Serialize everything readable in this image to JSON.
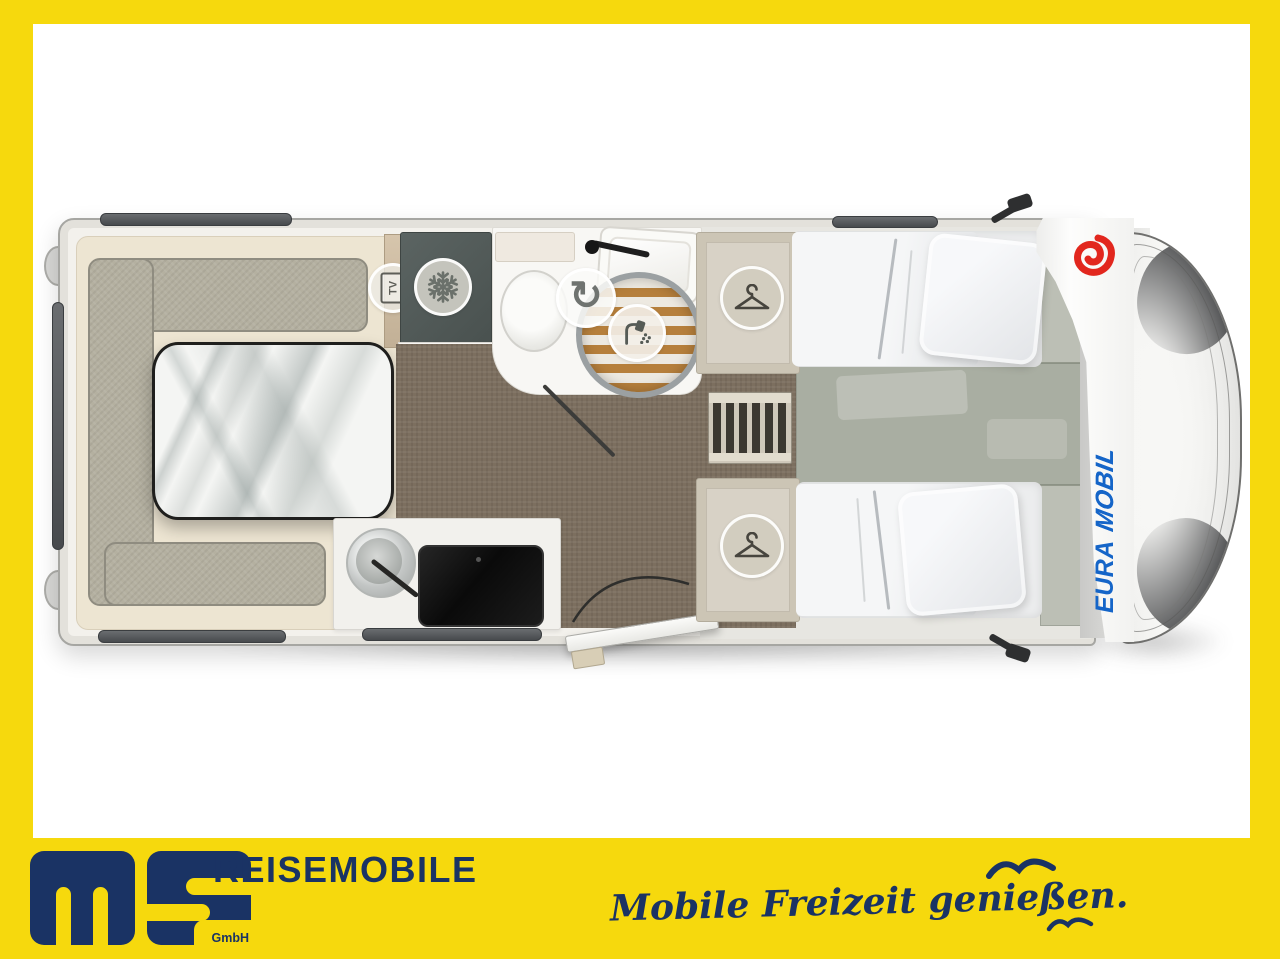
{
  "colors": {
    "frame_yellow": "#F6D90D",
    "navy": "#1A3364",
    "eura_blue": "#1565C8",
    "eura_red": "#E2271E"
  },
  "floorplan": {
    "brand_primary": "EURA",
    "brand_secondary": "MOBIL",
    "tv_label": "TV",
    "swivel_glyph": "↻",
    "features": [
      "tv-mount",
      "refrigerator",
      "swivel-toilet",
      "shower",
      "washbasin",
      "wardrobe-rear-bed",
      "wardrobe-front-bed",
      "kitchen-sink",
      "gas-hob",
      "dinette-table",
      "u-lounge",
      "single-bed",
      "single-bed",
      "bed-steps",
      "entry-door",
      "driver-cab"
    ]
  },
  "footer": {
    "logo_letters": "ms",
    "logo_suffix": "GmbH",
    "dealer_name": "REISEMOBILE",
    "slogan": "Mobile Freizeit genießen."
  }
}
